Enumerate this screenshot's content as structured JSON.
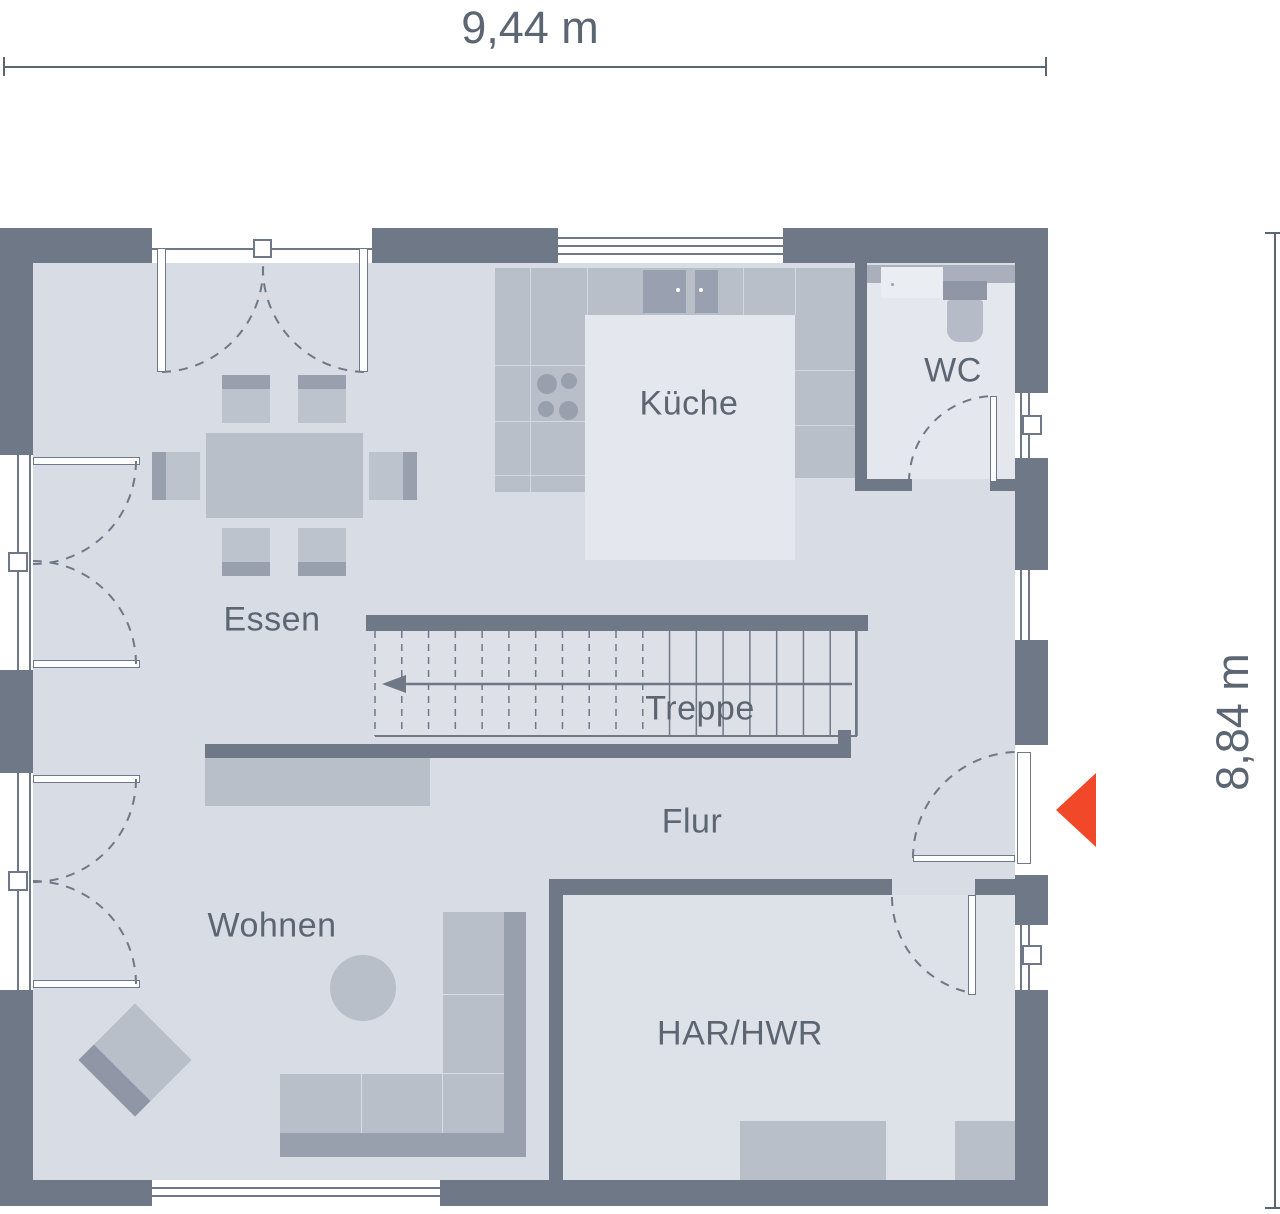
{
  "dimensions": {
    "width_label": "9,44 m",
    "height_label": "8,84 m"
  },
  "rooms": {
    "kitchen": "Küche",
    "wc": "WC",
    "dining": "Essen",
    "stairs": "Treppe",
    "hall": "Flur",
    "living": "Wohnen",
    "utility": "HAR/HWR"
  },
  "stairs": {
    "tread_count": 19,
    "dashed_treads": 11,
    "direction": "left"
  },
  "icons": {
    "entrance_arrow": "entrance-direction-arrow"
  },
  "colors": {
    "wall": "#6e7887",
    "floor": "#d8dce4",
    "floor_light": "#e4e7ed",
    "furniture": "#b9bfc9",
    "furniture_light": "#bdc3cd",
    "furniture_dark": "#98a0ae",
    "appliance": "#99a1b0",
    "accent": "#f1482a",
    "text": "#5c6572",
    "line": "#6e7887"
  }
}
